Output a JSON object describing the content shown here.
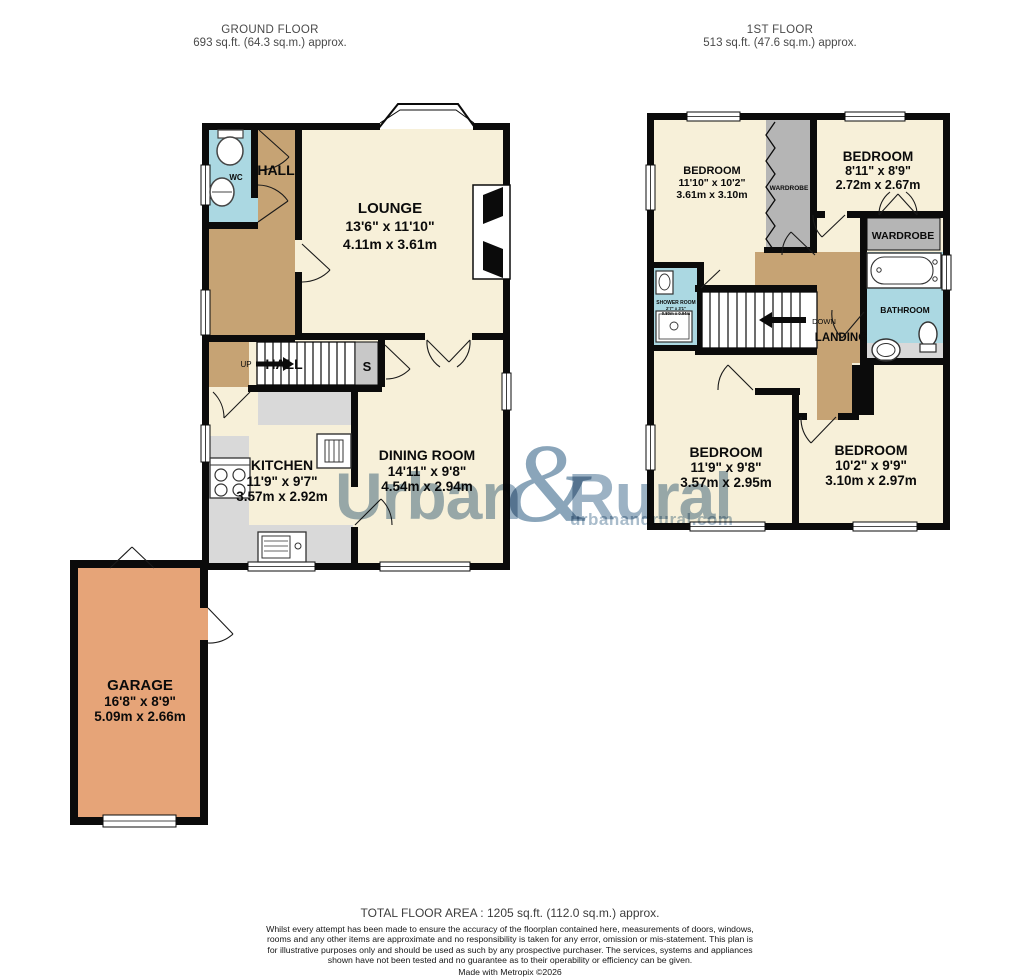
{
  "floors": {
    "ground": {
      "title": "GROUND FLOOR",
      "area": "693 sq.ft. (64.3 sq.m.) approx.",
      "rooms": {
        "wc": "WC",
        "hall": "HALL",
        "hall_stairs": "HALL",
        "up": "UP",
        "store": "S",
        "lounge": {
          "name": "LOUNGE",
          "imperial": "13'6\" x 11'10\"",
          "metric": "4.11m x 3.61m"
        },
        "kitchen": {
          "name": "KITCHEN",
          "imperial": "11'9\" x 9'7\"",
          "metric": "3.57m x 2.92m"
        },
        "dining": {
          "name": "DINING ROOM",
          "imperial": "14'11\" x 9'8\"",
          "metric": "4.54m x 2.94m"
        },
        "garage": {
          "name": "GARAGE",
          "imperial": "16'8\" x 8'9\"",
          "metric": "5.09m x 2.66m"
        }
      }
    },
    "first": {
      "title": "1ST FLOOR",
      "area": "513 sq.ft. (47.6 sq.m.) approx.",
      "rooms": {
        "bedroom1": {
          "name": "BEDROOM",
          "imperial": "11'10\" x 10'2\"",
          "metric": "3.61m x 3.10m"
        },
        "bedroom2": {
          "name": "BEDROOM",
          "imperial": "8'11\" x 8'9\"",
          "metric": "2.72m x 2.67m"
        },
        "bedroom3": {
          "name": "BEDROOM",
          "imperial": "11'9\" x 9'8\"",
          "metric": "3.57m x 2.95m"
        },
        "bedroom4": {
          "name": "BEDROOM",
          "imperial": "10'2\" x 9'9\"",
          "metric": "3.10m x 2.97m"
        },
        "wardrobe_left": "WARDROBE",
        "wardrobe_right": "WARDROBE",
        "bathroom": "BATHROOM",
        "shower": {
          "name": "SHOWER ROOM",
          "imperial": "2'7\" x 3'1\"",
          "metric": "0.80m x 0.94m"
        },
        "landing": "LANDING",
        "down": "DOWN"
      }
    }
  },
  "watermark": {
    "part1": "Urban",
    "amp": "&",
    "part2": "Rural",
    "subtitle": "urbanandrural.com"
  },
  "footer": {
    "total": "TOTAL FLOOR AREA : 1205 sq.ft. (112.0 sq.m.) approx.",
    "disclaimer": "Whilst every attempt has been made to ensure the accuracy of the floorplan contained here, measurements of doors, windows, rooms and any other items are approximate and no responsibility is taken for any error, omission or mis-statement. This plan is for illustrative purposes only and should be used as such by any prospective purchaser. The services, systems and appliances shown have not been tested and no guarantee as to their operability or efficiency can be given.",
    "credit": "Made with Metropix ©2026"
  },
  "colors": {
    "room_fill": "#F7F0D9",
    "hall_fill": "#C6A374",
    "wet_room_fill": "#ABD8E2",
    "garage_fill": "#E6A478",
    "wardrobe_fill": "#B5B5B5",
    "counter_fill": "#D9D9D9",
    "wall": "#0B0B0B",
    "watermark": "#9CB2C4"
  }
}
